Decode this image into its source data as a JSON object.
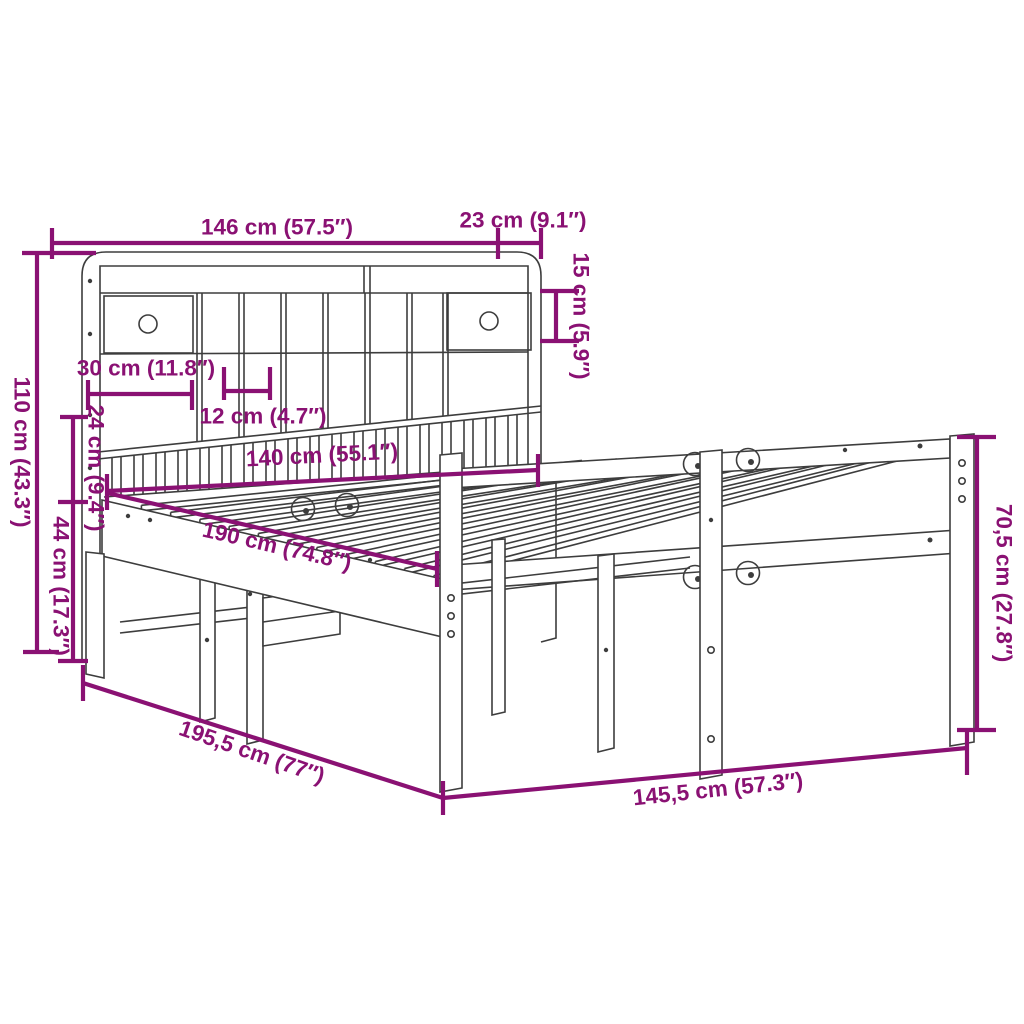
{
  "diagram": {
    "type": "product-dimension-diagram",
    "subject": "bookcase-bed-frame-with-shelf-headboard",
    "colors": {
      "dimension": "#8a1173",
      "line": "#3d3d3d",
      "background": "#ffffff"
    },
    "dimensions": [
      {
        "id": "headboard-width",
        "label": "146 cm (57.5″)"
      },
      {
        "id": "headboard-side-depth",
        "label": "23 cm (9.1″)"
      },
      {
        "id": "top-shelf-height",
        "label": "15 cm (5.9″)"
      },
      {
        "id": "drawer-width",
        "label": "30 cm (11.8″)"
      },
      {
        "id": "compartment-width",
        "label": "12 cm (4.7″)"
      },
      {
        "id": "mattress-width",
        "label": "140 cm (55.1″)"
      },
      {
        "id": "mattress-length",
        "label": "190 cm (74.8″)"
      },
      {
        "id": "shelf-gap-height",
        "label": "24 cm (9.4″)"
      },
      {
        "id": "frame-height",
        "label": "44 cm (17.3″)"
      },
      {
        "id": "headboard-height",
        "label": "110 cm (43.3″)"
      },
      {
        "id": "overall-length",
        "label": "195,5 cm (77″)"
      },
      {
        "id": "overall-width",
        "label": "145,5 cm (57.3″)"
      },
      {
        "id": "footboard-height",
        "label": "70,5 cm (27.8″)"
      }
    ]
  }
}
